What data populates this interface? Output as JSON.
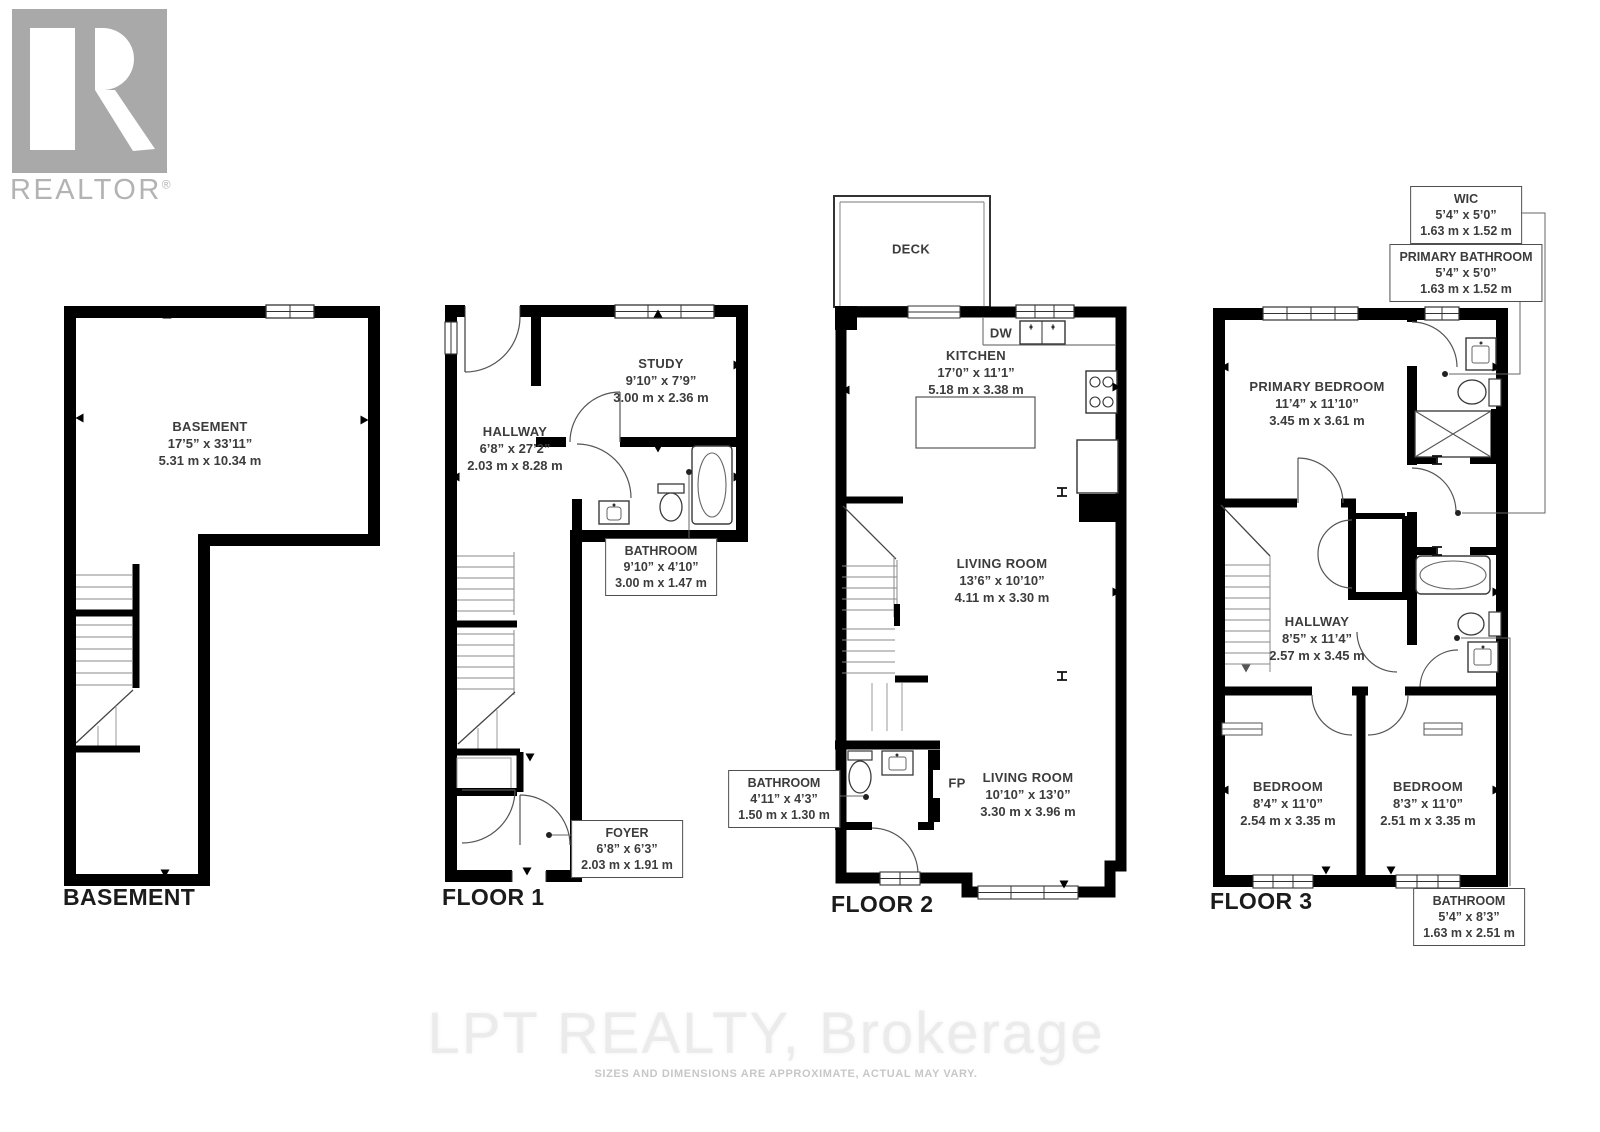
{
  "branding": {
    "logo_text": "REALTOR",
    "registered_mark": "®"
  },
  "watermark": {
    "brokerage": "LPT REALTY, Brokerage",
    "disclaimer": "SIZES AND DIMENSIONS ARE APPROXIMATE, ACTUAL MAY VARY."
  },
  "plans": {
    "basement": {
      "title": "BASEMENT",
      "room": {
        "name": "BASEMENT",
        "imperial": "17’5” x 33’11”",
        "metric": "5.31 m x 10.34 m"
      }
    },
    "floor1": {
      "title": "FLOOR 1",
      "hallway": {
        "name": "HALLWAY",
        "imperial": "6’8” x 27’2”",
        "metric": "2.03 m x 8.28 m"
      },
      "study": {
        "name": "STUDY",
        "imperial": "9’10” x 7’9”",
        "metric": "3.00 m x 2.36 m"
      },
      "bathroom": {
        "name": "BATHROOM",
        "imperial": "9’10” x 4’10”",
        "metric": "3.00 m x 1.47 m"
      },
      "foyer": {
        "name": "FOYER",
        "imperial": "6’8” x 6’3”",
        "metric": "2.03 m x 1.91 m"
      }
    },
    "floor2": {
      "title": "FLOOR 2",
      "deck": "DECK",
      "dishwasher": "DW",
      "fireplace": "FP",
      "kitchen": {
        "name": "KITCHEN",
        "imperial": "17’0” x 11’1”",
        "metric": "5.18 m x 3.38 m"
      },
      "living_room_upper": {
        "name": "LIVING ROOM",
        "imperial": "13’6” x 10’10”",
        "metric": "4.11 m x 3.30 m"
      },
      "bathroom": {
        "name": "BATHROOM",
        "imperial": "4’11” x 4’3”",
        "metric": "1.50 m x 1.30 m"
      },
      "living_room_lower": {
        "name": "LIVING ROOM",
        "imperial": "10’10” x 13’0”",
        "metric": "3.30 m x 3.96 m"
      }
    },
    "floor3": {
      "title": "FLOOR 3",
      "wic": {
        "name": "WIC",
        "imperial": "5’4” x 5’0”",
        "metric": "1.63 m x 1.52 m"
      },
      "primary_bathroom": {
        "name": "PRIMARY BATHROOM",
        "imperial": "5’4” x 5’0”",
        "metric": "1.63 m x 1.52 m"
      },
      "primary_bedroom": {
        "name": "PRIMARY BEDROOM",
        "imperial": "11’4” x 11’10”",
        "metric": "3.45 m x 3.61 m"
      },
      "hallway": {
        "name": "HALLWAY",
        "imperial": "8’5” x 11’4”",
        "metric": "2.57 m x 3.45 m"
      },
      "bedroom_left": {
        "name": "BEDROOM",
        "imperial": "8’4” x 11’0”",
        "metric": "2.54 m x 3.35 m"
      },
      "bedroom_right": {
        "name": "BEDROOM",
        "imperial": "8’3” x 11’0”",
        "metric": "2.51 m x 3.35 m"
      },
      "bathroom": {
        "name": "BATHROOM",
        "imperial": "5’4” x 8’3”",
        "metric": "1.63 m x 2.51 m"
      }
    }
  }
}
